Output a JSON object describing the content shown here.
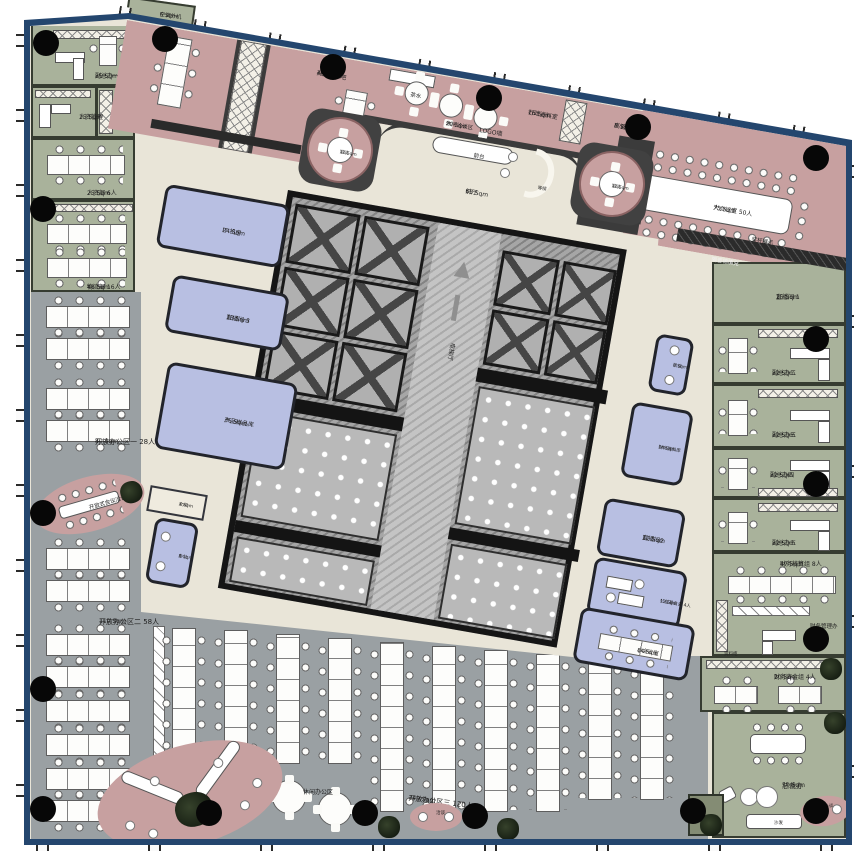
{
  "rooms": {
    "ac": {
      "name": "空调外机",
      "area": "6 Sqm"
    },
    "vp1": {
      "name": "副总办一",
      "area": "25 Sqm"
    },
    "hr_mgmt": {
      "name": "人资管理",
      "area": "15 Sqm"
    },
    "hr_file": {
      "name": "人资资料",
      "area": "10 Sqm"
    },
    "hr_dept": {
      "name": "人资部 6人",
      "area": "25 Sqm"
    },
    "logistics": {
      "name": "物流部 16人",
      "area": "48 Sqm"
    },
    "meet24": {
      "name": "小会议室",
      "area": "24 Sqm"
    },
    "bookbar": {
      "name": "开放式书吧",
      "area": "40 Sqm"
    },
    "tea": {
      "name": "茶水"
    },
    "lounge20": {
      "name": "休闲洽谈区",
      "area": "20 Sqm"
    },
    "pod1": {
      "name": "洽谈",
      "area": "12 Sqm"
    },
    "pod2": {
      "name": "洽谈",
      "area": "12 Sqm"
    },
    "logo_wall": {
      "name": "LOGO墙"
    },
    "reception": {
      "name": "前台"
    },
    "lobby": {
      "name": "前厅",
      "area": "65 Sqm"
    },
    "waiting": {
      "name": "等候"
    },
    "admin_file": {
      "name": "行政资料室",
      "area": "16 Sqm"
    },
    "exec_file": {
      "name": "高管资料室",
      "area": "8 Sqm"
    },
    "screen": {
      "name": "电子屏"
    },
    "grand": {
      "name": "大会议室 50人",
      "area": "75 Sqm"
    },
    "trophy": {
      "name": "奖杯展示"
    },
    "soundproof": {
      "name": "隔音棉填充"
    },
    "live1": {
      "name": "直播间 1",
      "area": "25 Sqm"
    },
    "vp2": {
      "name": "副总办二",
      "area": "22 Sqm"
    },
    "vp3": {
      "name": "副总办三",
      "area": "22 Sqm"
    },
    "vp4": {
      "name": "副总办四",
      "area": "22 Sqm"
    },
    "vp5": {
      "name": "副总办五",
      "area": "22 Sqm"
    },
    "fin_acct": {
      "name": "财务核算组 8人",
      "area": "47 Sqm"
    },
    "fin_mgr": {
      "name": "财务管理办"
    },
    "cabinet": {
      "name": "资料柜"
    },
    "fin_cash": {
      "name": "财务资金组 4人",
      "area": "20 Sqm"
    },
    "ceo": {
      "name": "总裁办",
      "area": "50 Sqm"
    },
    "sofa": {
      "name": "沙发"
    },
    "storage": {
      "name": "储藏间",
      "area": "4 Sqm"
    },
    "it": {
      "name": "IT 机房",
      "area": "24 Sqm"
    },
    "live3": {
      "name": "直播间 3",
      "area": "13 Sqm"
    },
    "sample": {
      "name": "产品样品库",
      "area": "36 Sqm"
    },
    "print": {
      "name": "文印",
      "area": "4 Sqm"
    },
    "office8": {
      "name": "办公",
      "area": "8 Sqm"
    },
    "talk8": {
      "name": "洽谈",
      "area": "8 Sqm"
    },
    "fin_file": {
      "name": "财务资料库",
      "area": "14 Sqm"
    },
    "live2": {
      "name": "直播间2",
      "area": "11 Sqm"
    },
    "charity": {
      "name": "公益基金会 4人",
      "area": "13 Sqm"
    },
    "meet14": {
      "name": "小会议室",
      "area": "14 Sqm"
    },
    "open1": {
      "name": "开放办公区一  28人",
      "area": "80 Sqm"
    },
    "open2": {
      "name": "开放办公区二  58人",
      "area": "110 Sqm"
    },
    "open3": {
      "name": "开放办公区三  120人",
      "area": "240 Sqm"
    },
    "oval_meet": {
      "name": "开放式会议洽谈"
    },
    "leisure": {
      "name": "休闲办公区"
    },
    "talk_s": {
      "name": "洽谈"
    },
    "lift": {
      "name": "电梯厅"
    }
  },
  "colors": {
    "border": "#24466e",
    "office_green": "#a9b29b",
    "band_pink": "#c7a0a0",
    "open_gray": "#9aa0a3",
    "room_blue": "#b8bfe2",
    "floor": "#e9e5d8",
    "wall_dark": "#3b3b3b"
  }
}
